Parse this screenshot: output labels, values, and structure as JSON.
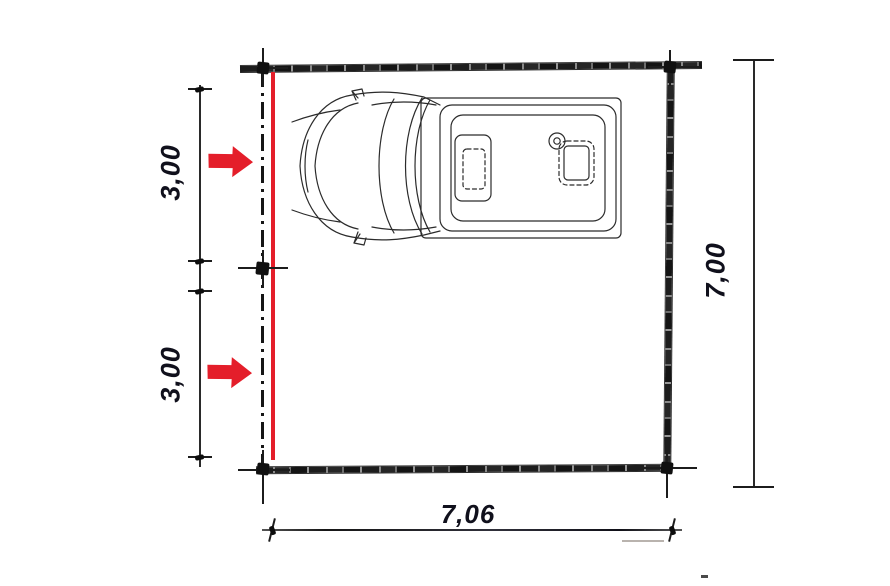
{
  "drawing": {
    "kind": "garage floor plan, top view, with camper van parked inside",
    "dimension_labels": {
      "left_top": "3,00",
      "left_bottom": "3,00",
      "right": "7,00",
      "bottom": "7,06"
    },
    "colors": {
      "accent_red": "#e41e2a",
      "ink": "#1c1c1c",
      "paper": "#ffffff"
    },
    "icons": {
      "door_marker": "red-right-arrow-icon",
      "vehicle": "camper-van-top-view",
      "opening_line": "red-opening-line"
    }
  }
}
